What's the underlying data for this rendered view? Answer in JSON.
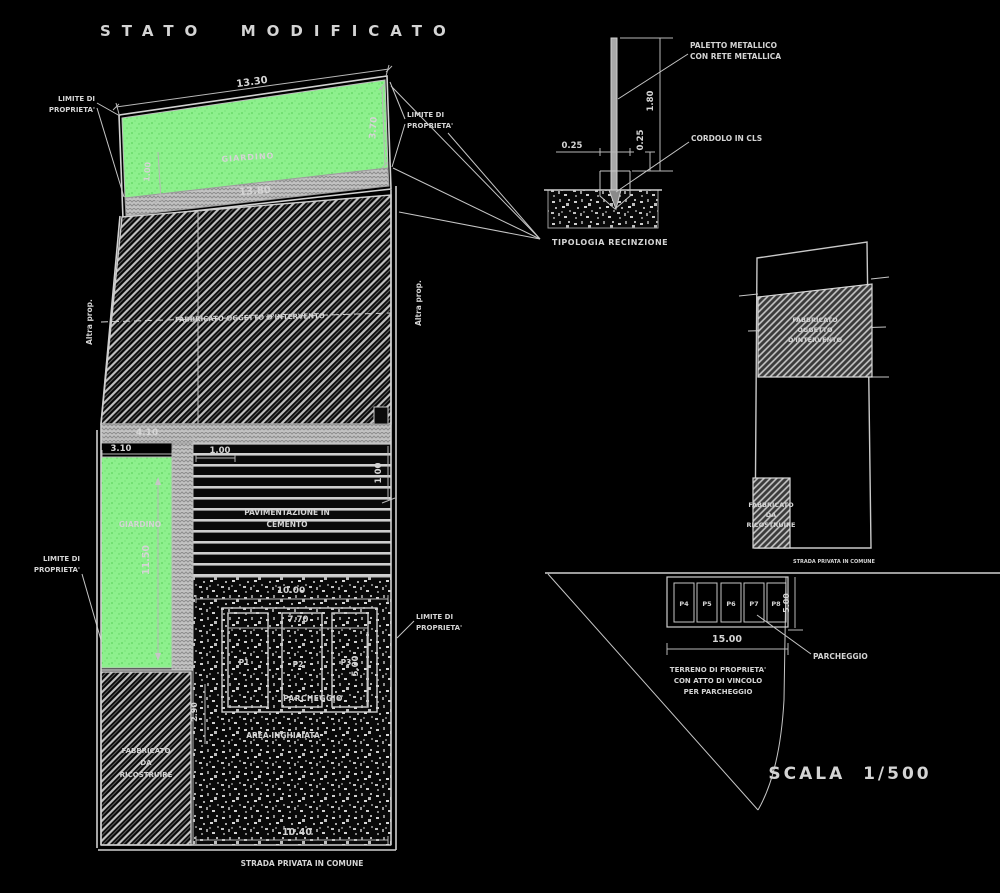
{
  "title": "STATO  MODIFICATO",
  "colors": {
    "garden_green": "#8DF08D",
    "linework": "#C8C8C8",
    "band_grey": "#C2C2C2"
  },
  "labels": {
    "limite": [
      "LIMITE DI",
      "PROPRIETA'"
    ],
    "altra_prop": "Altra prop."
  },
  "plan": {
    "garden_top": {
      "name": "GIARDINO",
      "dim_top": "13.30",
      "dim_bottom": "13.80",
      "dim_right": "3.70",
      "dim_left": "1.00"
    },
    "building": {
      "label": "FABBRICATO OGGETTO D'INTERVENTO"
    },
    "dims": {
      "w_strip": "4.10",
      "w_garden": "3.10",
      "w_band": "1.00",
      "h_band": "1.00",
      "h_garden": "11.50",
      "w_gravel": "10.00",
      "w_stalls": "7.70",
      "h_stalls": "5.00",
      "h_gap": "2.90",
      "w_bottom": "10.40"
    },
    "garden_mid": {
      "name": "GIARDINO"
    },
    "paving": {
      "lines": [
        "PAVIMENTAZIONE IN",
        "CEMENTO"
      ]
    },
    "stalls": [
      "P1",
      "P2",
      "P3"
    ],
    "parcheggio": "PARCHEGGIO",
    "area_inghiaiata": "AREA INGHIAIATA",
    "rebuild": [
      "FABBRICATO",
      "DA",
      "RICOSTRUIRE"
    ],
    "strada": "STRADA PRIVATA IN COMUNE"
  },
  "fence": {
    "post_label": [
      "PALETTO METALLICO",
      "CON RETE METALLICA"
    ],
    "curb_label": "CORDOLO IN CLS",
    "dims": {
      "height": "1.80",
      "width": "0.25",
      "curb": "0.25"
    },
    "caption": "TIPOLOGIA RECINZIONE"
  },
  "lot": {
    "building": [
      "FABBRICATO",
      "OGGETTO",
      "D'INTERVENTO"
    ],
    "rebuild": [
      "FABBRICATO",
      "DA",
      "RICOSTRUIRE"
    ]
  },
  "parking": {
    "stalls": [
      "P4",
      "P5",
      "P6",
      "P7",
      "P8"
    ],
    "dims": {
      "width": "15.00",
      "depth": "5.00"
    },
    "label": "PARCHEGGIO",
    "terreno": [
      "TERRENO DI PROPRIETA'",
      "CON ATTO DI VINCOLO",
      "PER PARCHEGGIO"
    ],
    "strada": "STRADA PRIVATA IN COMUNE",
    "scale": "SCALA  1/500"
  }
}
